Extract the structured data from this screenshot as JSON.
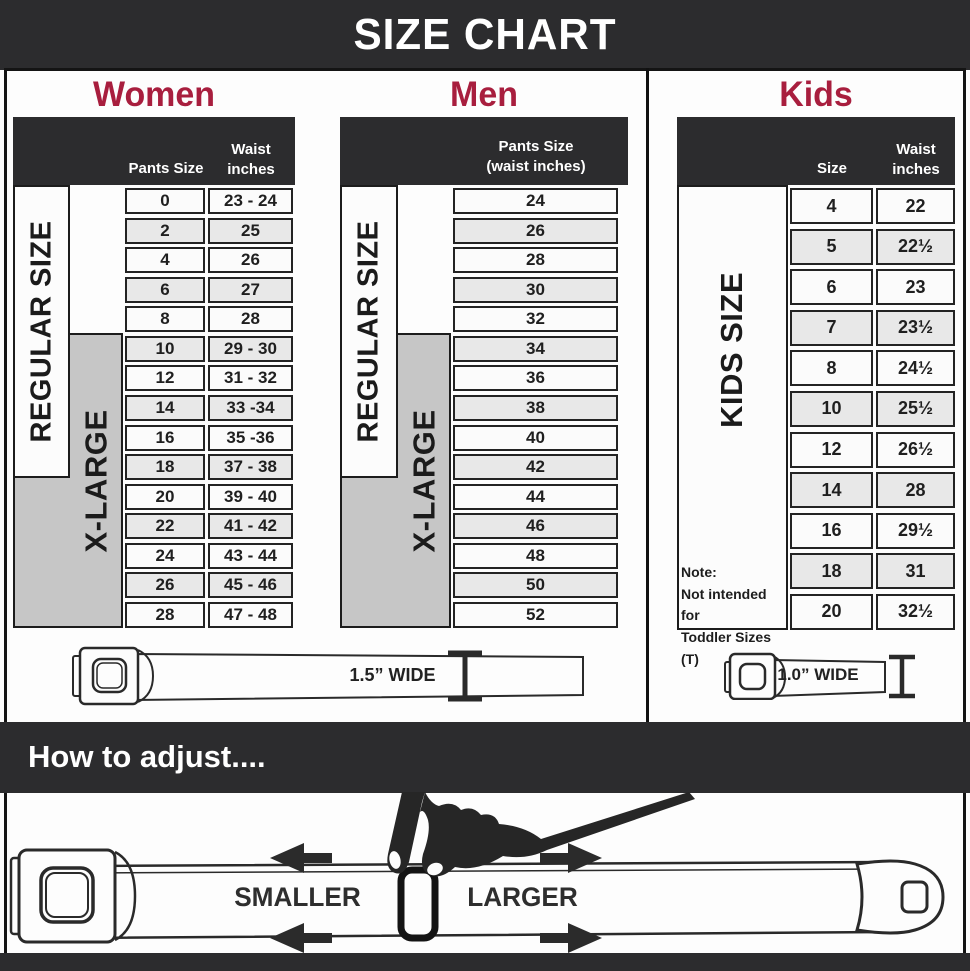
{
  "title": "SIZE CHART",
  "colors": {
    "dark": "#2c2c2e",
    "accent_red": "#a81e3e",
    "gray_box": "#c6c6c6",
    "row_alt": "#e8e8e8",
    "line": "#222222"
  },
  "sections": {
    "women": {
      "title": "Women",
      "header_pants": "Pants Size",
      "header_waist": "Waist inches",
      "regular_label": "REGULAR SIZE",
      "xlarge_label": "X-LARGE",
      "belt_width_label": "1.5” WIDE",
      "rows": [
        {
          "size": "0",
          "waist": "23 - 24"
        },
        {
          "size": "2",
          "waist": "25"
        },
        {
          "size": "4",
          "waist": "26"
        },
        {
          "size": "6",
          "waist": "27"
        },
        {
          "size": "8",
          "waist": "28"
        },
        {
          "size": "10",
          "waist": "29 - 30"
        },
        {
          "size": "12",
          "waist": "31 - 32"
        },
        {
          "size": "14",
          "waist": "33 -34"
        },
        {
          "size": "16",
          "waist": "35 -36"
        },
        {
          "size": "18",
          "waist": "37 - 38"
        },
        {
          "size": "20",
          "waist": "39 - 40"
        },
        {
          "size": "22",
          "waist": "41 - 42"
        },
        {
          "size": "24",
          "waist": "43 - 44"
        },
        {
          "size": "26",
          "waist": "45 - 46"
        },
        {
          "size": "28",
          "waist": "47 - 48"
        }
      ]
    },
    "men": {
      "title": "Men",
      "header_line1": "Pants Size",
      "header_line2": "(waist inches)",
      "regular_label": "REGULAR SIZE",
      "xlarge_label": "X-LARGE",
      "rows": [
        "24",
        "26",
        "28",
        "30",
        "32",
        "34",
        "36",
        "38",
        "40",
        "42",
        "44",
        "46",
        "48",
        "50",
        "52"
      ]
    },
    "kids": {
      "title": "Kids",
      "header_size": "Size",
      "header_waist": "Waist inches",
      "side_label": "KIDS SIZE",
      "belt_width_label": "1.0” WIDE",
      "note": {
        "l1": "Note:",
        "l2": "Not intended for",
        "l3": "Toddler Sizes (T)"
      },
      "rows": [
        {
          "size": "4",
          "waist": "22"
        },
        {
          "size": "5",
          "waist": "22½"
        },
        {
          "size": "6",
          "waist": "23"
        },
        {
          "size": "7",
          "waist": "23½"
        },
        {
          "size": "8",
          "waist": "24½"
        },
        {
          "size": "10",
          "waist": "25½"
        },
        {
          "size": "12",
          "waist": "26½"
        },
        {
          "size": "14",
          "waist": "28"
        },
        {
          "size": "16",
          "waist": "29½"
        },
        {
          "size": "18",
          "waist": "31"
        },
        {
          "size": "20",
          "waist": "32½"
        }
      ]
    }
  },
  "how_to": {
    "title": "How to adjust....",
    "smaller": "SMALLER",
    "larger": "LARGER"
  }
}
